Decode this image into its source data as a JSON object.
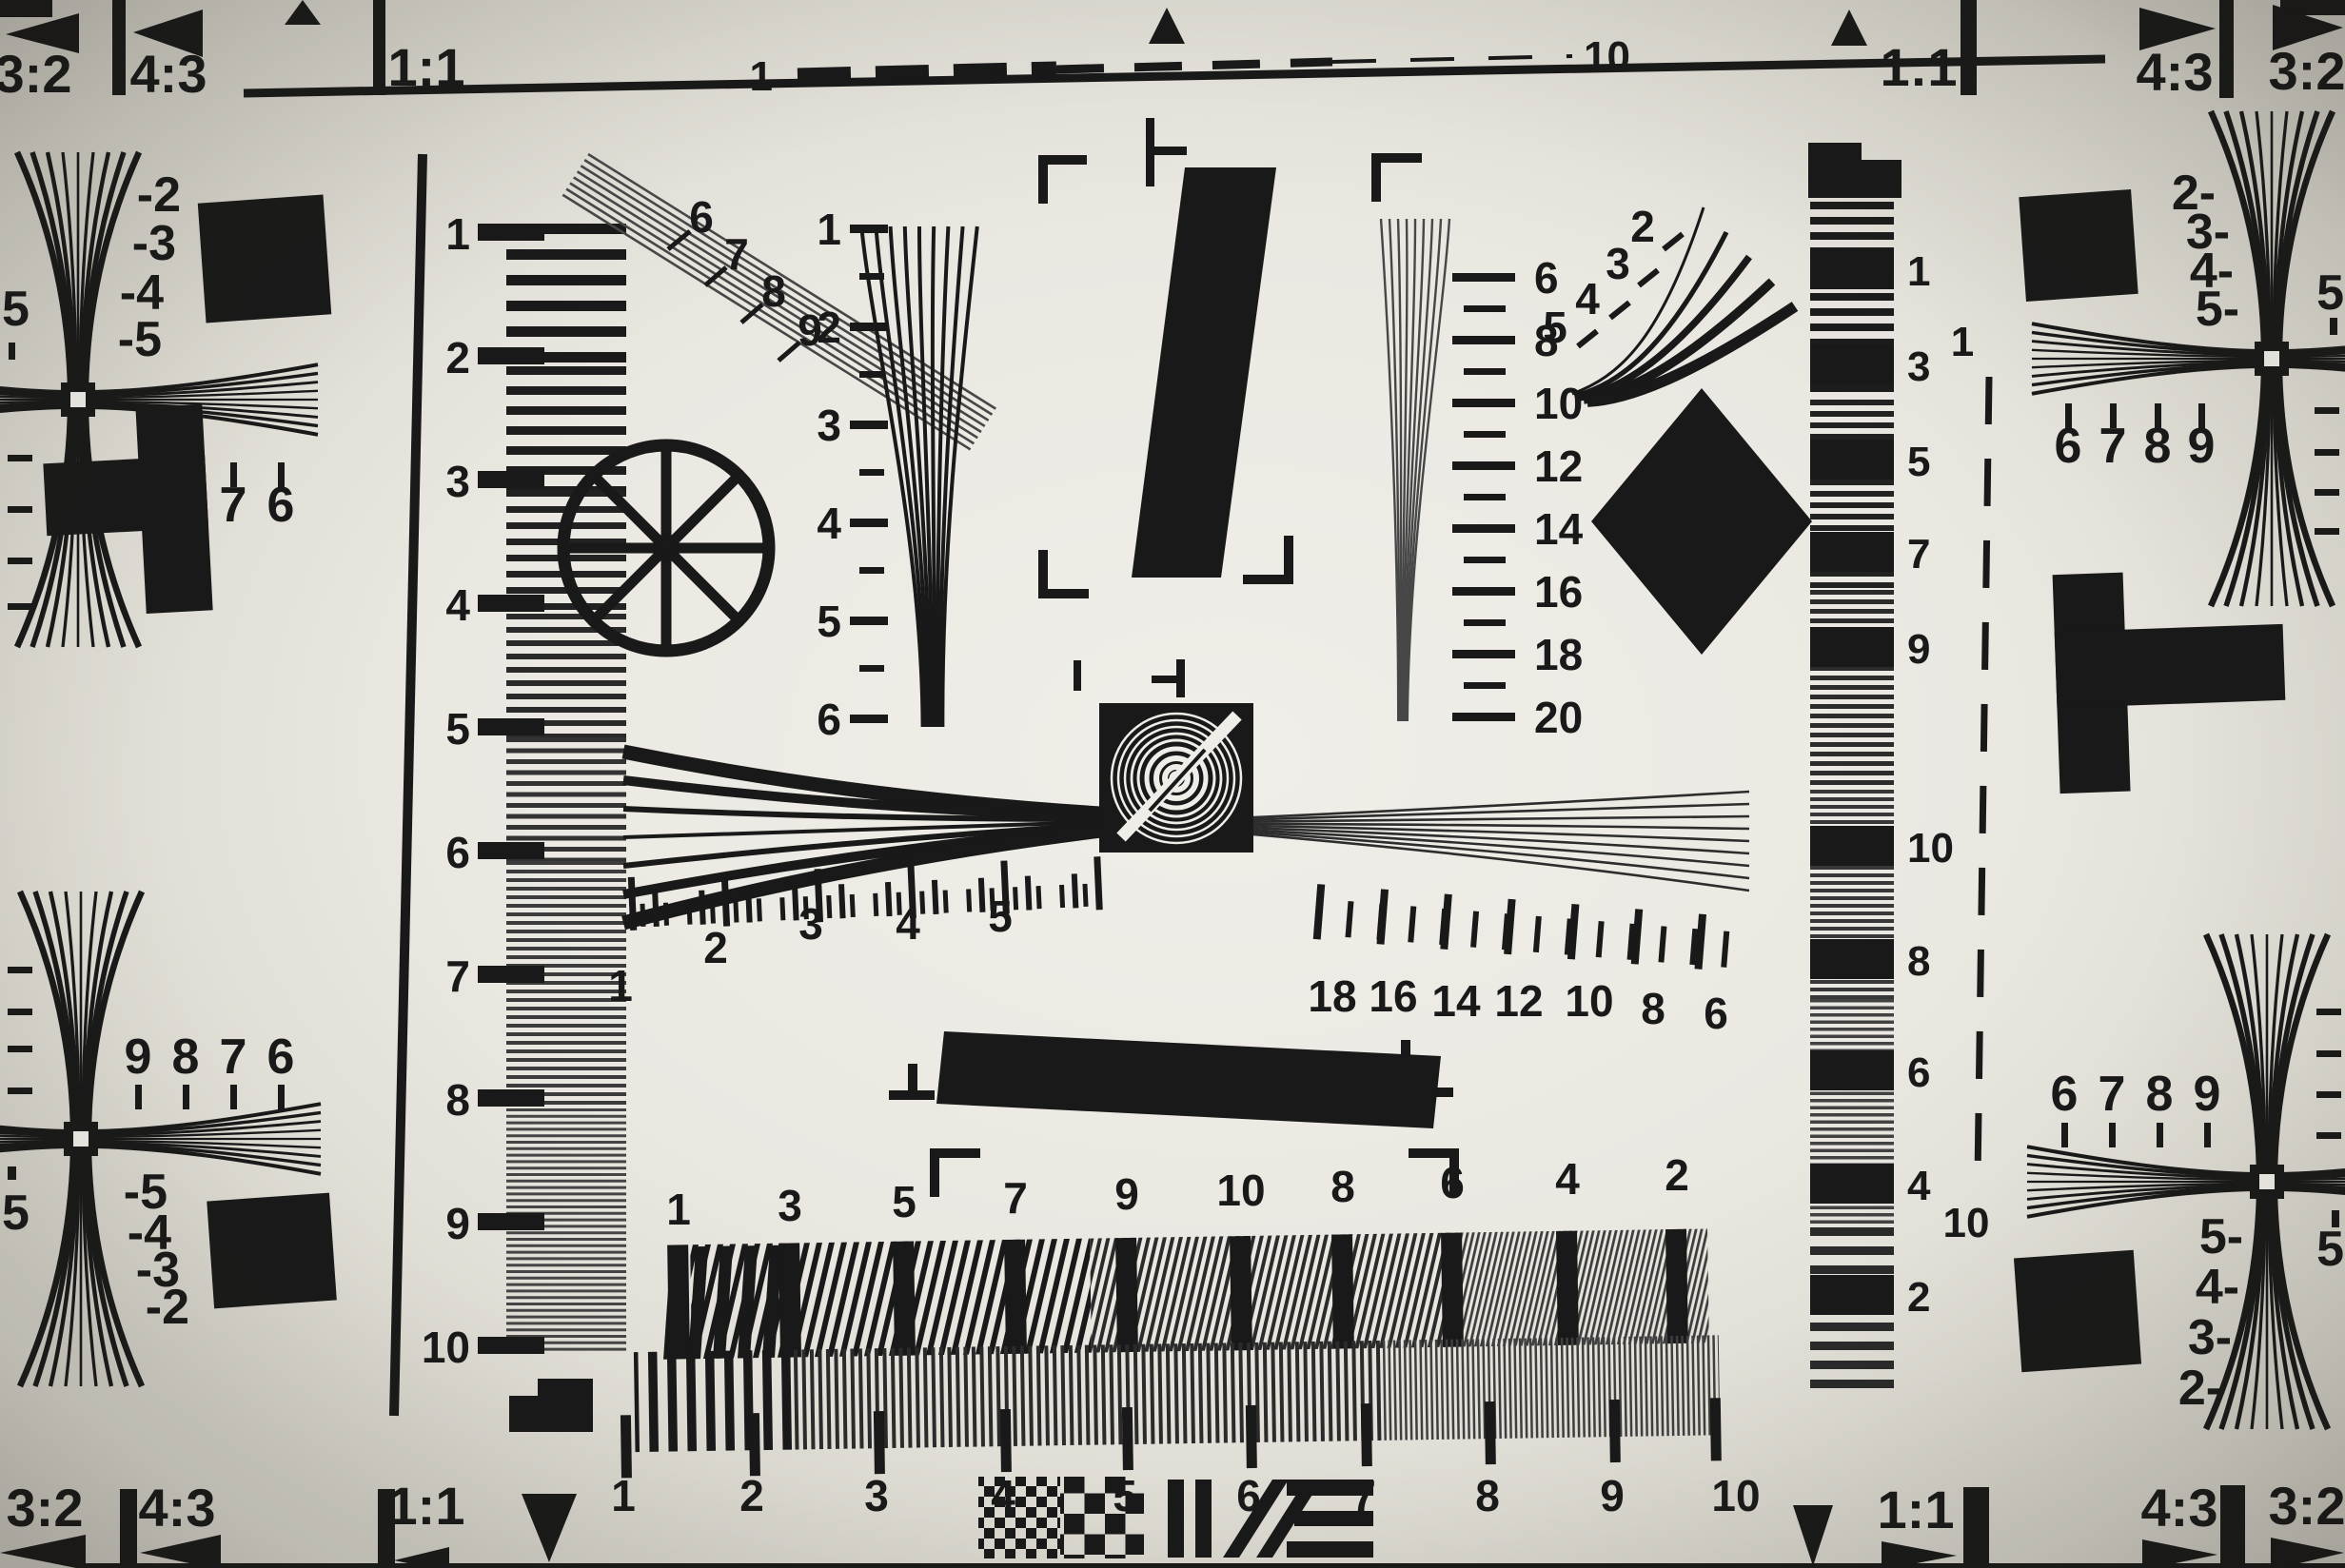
{
  "colors": {
    "paper": "#eceae3",
    "ink": "#191919",
    "fine_gray": "#4d4d4d"
  },
  "corners": {
    "top_left": [
      "3:2",
      "4:3",
      "1:1"
    ],
    "top_right": [
      "1:1",
      "4:3",
      "3:2"
    ],
    "bottom_left": [
      "3:2",
      "4:3",
      "1:1"
    ],
    "bottom_right": [
      "1:1",
      "4:3",
      "3:2"
    ]
  },
  "top_scale": {
    "start": "1",
    "end": "10"
  },
  "left_ruler": [
    "1",
    "2",
    "3",
    "4",
    "5",
    "6",
    "7",
    "8",
    "9",
    "10"
  ],
  "left_edge": {
    "top_wedge": [
      "-2",
      "-3",
      "-4",
      "-5"
    ],
    "top_number_row": [
      "9",
      "8",
      "7",
      "6"
    ],
    "top_edge_number": "5",
    "bottom_number_row": [
      "9",
      "8",
      "7",
      "6"
    ],
    "bottom_wedge": [
      "-5",
      "-4",
      "-3",
      "-2"
    ],
    "bottom_edge_number": "5"
  },
  "right_edge": {
    "top_wedge": [
      "2-",
      "3-",
      "4-",
      "5-"
    ],
    "top_number_row": [
      "6",
      "7",
      "8",
      "9"
    ],
    "top_edge_number": "5",
    "bottom_number_row": [
      "6",
      "7",
      "8",
      "9"
    ],
    "bottom_wedge": [
      "5-",
      "4-",
      "3-",
      "2-"
    ],
    "bottom_edge_number": "5"
  },
  "diag_fan_labels": [
    "6",
    "7",
    "8",
    "9"
  ],
  "curve_fan_labels": [
    "2",
    "3",
    "4",
    "5"
  ],
  "center_vertical_scale": [
    "1",
    "2",
    "3",
    "4",
    "5",
    "6"
  ],
  "right_vertical_scale": [
    "6",
    "8",
    "10",
    "12",
    "14",
    "16",
    "18",
    "20"
  ],
  "center_horizontal_scale_left": [
    "1",
    "2",
    "3",
    "4",
    "5"
  ],
  "center_horizontal_scale_right": [
    "18",
    "16",
    "14",
    "12",
    "10",
    "8",
    "6"
  ],
  "right_strip_scale": [
    "1",
    "3",
    "5",
    "7",
    "9",
    "10",
    "8",
    "6",
    "4",
    "2"
  ],
  "right_dash_scale": {
    "top": "1",
    "bottom": "10"
  },
  "bottom_scale_top": [
    "1",
    "3",
    "5",
    "7",
    "9",
    "10",
    "8",
    "6",
    "4",
    "2"
  ],
  "bottom_scale_bottom": [
    "1",
    "2",
    "3",
    "4",
    "5",
    "6",
    "7",
    "8",
    "9",
    "10"
  ]
}
